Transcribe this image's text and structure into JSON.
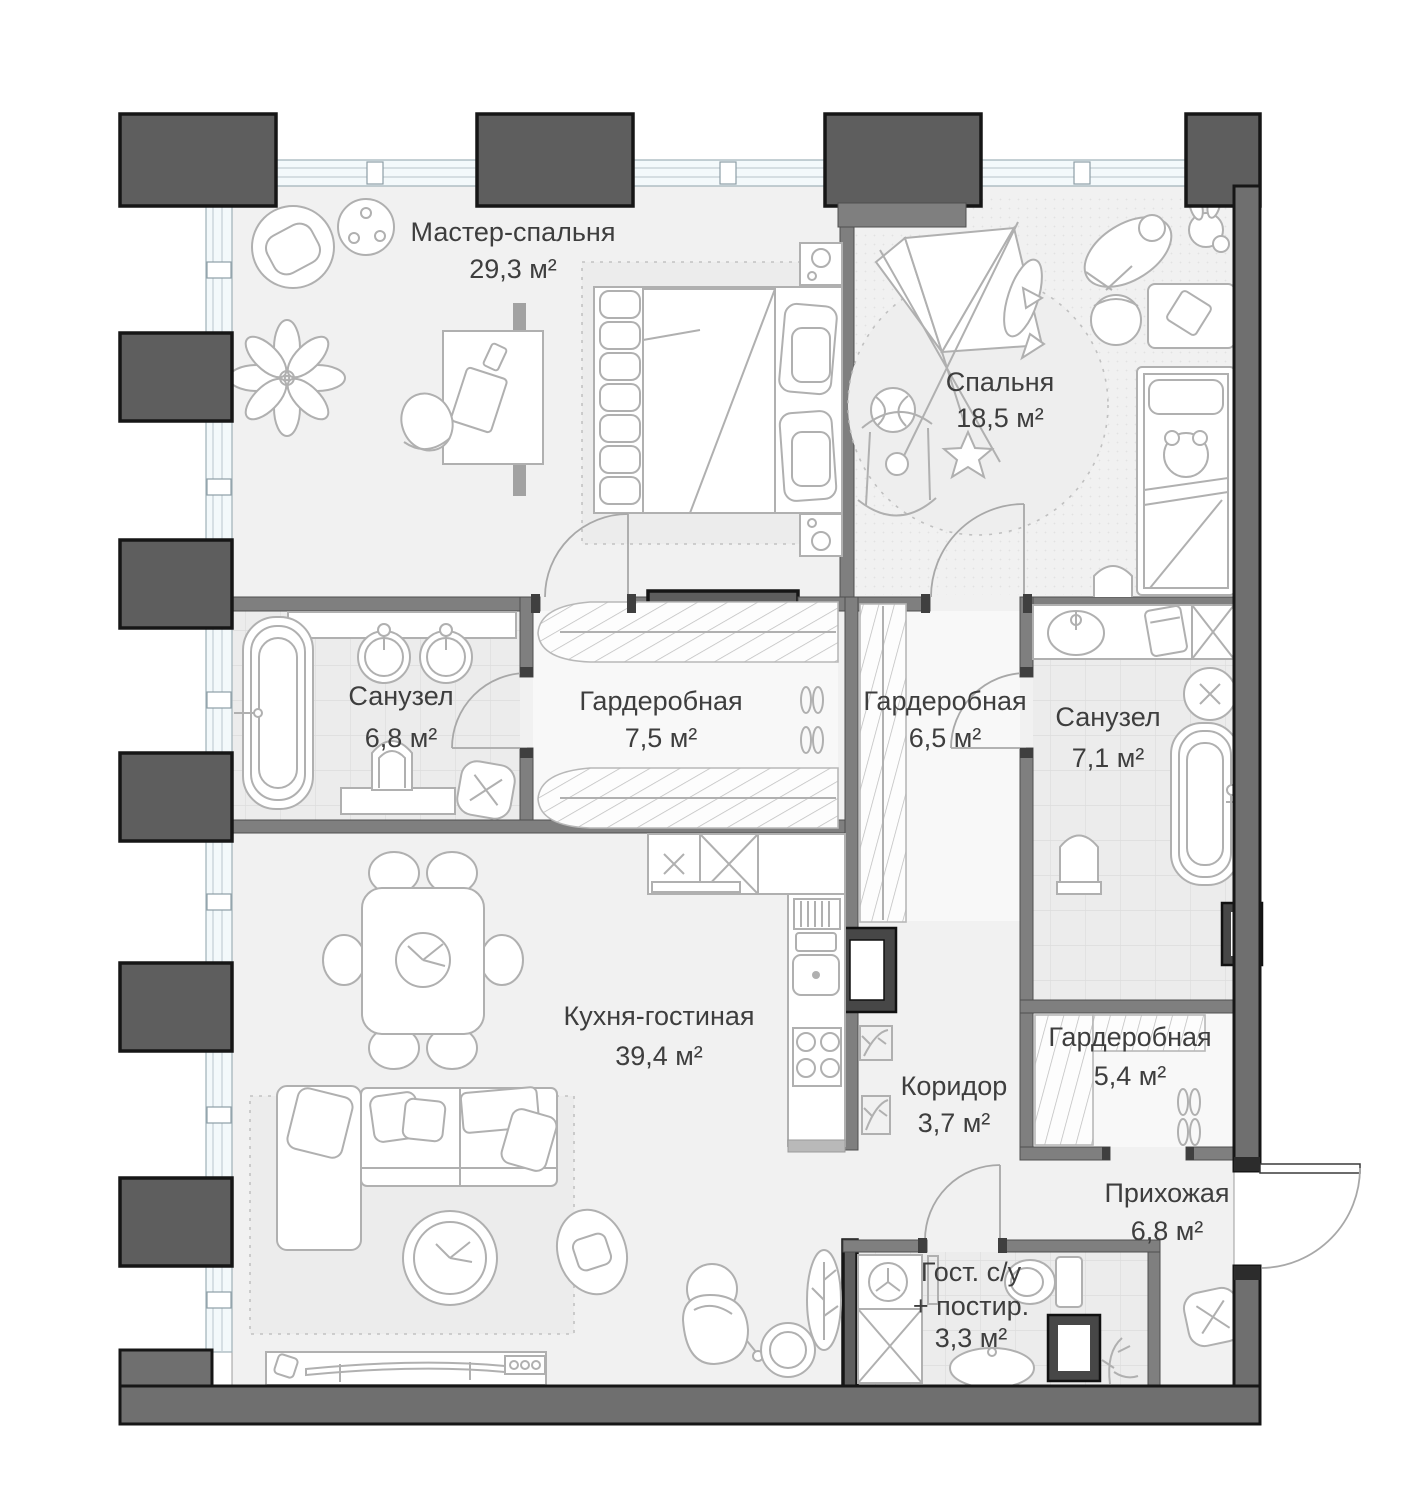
{
  "colors": {
    "column_fill": "#5e5e5e",
    "perimeter_wall_fill": "#6f6f6f",
    "interior_wall_fill": "#7f7f7f",
    "outline": "#161616",
    "floor": "#f1f1f1",
    "tile_floor": "#ececec",
    "window_fill": "#f3f9fb",
    "furniture_stroke": "#b0b0b0",
    "label_text": "#3e3e3e"
  },
  "rooms": [
    {
      "name": "Мастер-спальня",
      "area": "29,3 м²"
    },
    {
      "name": "Спальня",
      "area": "18,5 м²"
    },
    {
      "name": "Санузел",
      "area": "6,8 м²"
    },
    {
      "name": "Гардеробная",
      "area": "7,5 м²"
    },
    {
      "name": "Гардеробная",
      "area": "6,5 м²"
    },
    {
      "name": "Санузел",
      "area": "7,1 м²"
    },
    {
      "name": "Кухня-гостиная",
      "area": "39,4 м²"
    },
    {
      "name": "Коридор",
      "area": "3,7 м²"
    },
    {
      "name": "Гардеробная",
      "area": "5,4 м²"
    },
    {
      "name": "Прихожая",
      "area": "6,8 м²"
    },
    {
      "name": "Гост. с/у",
      "name2": "+ постир.",
      "area": "3,3 м²"
    }
  ]
}
